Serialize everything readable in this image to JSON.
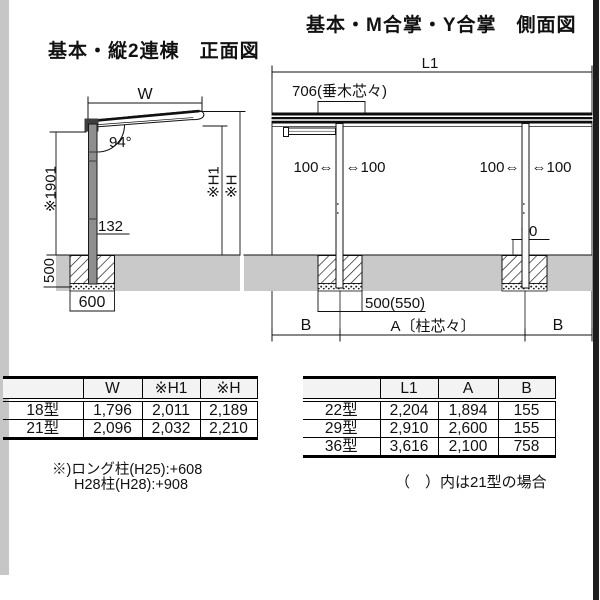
{
  "page": {
    "front_title": "基本・縦2連棟　正面図",
    "side_title": "基本・M合掌・Y合掌　側面図"
  },
  "colors": {
    "ground": "#c9c9c9",
    "ink": "#111111",
    "edge_bar": "#1e1e1e"
  },
  "front_view": {
    "dim_w": "W",
    "dim_angle": "94°",
    "dim_post_height": "※1901",
    "dim_h1": "※H1",
    "dim_h": "※H",
    "dim_base": "132",
    "dim_footing_depth": "500",
    "dim_footing_width": "600"
  },
  "side_view": {
    "dim_l1": "L1",
    "dim_rafter": "706(垂木芯々)",
    "dim_overhang_left_out": "100⇔",
    "dim_overhang_left_in": "⇔100",
    "dim_overhang_right_out": "100⇔",
    "dim_overhang_right_in": "⇔100",
    "dim_edge": "90",
    "dim_footing": "500(550)",
    "dim_b_left": "B",
    "dim_a": "A〔柱芯々〕",
    "dim_b_right": "B"
  },
  "front_table": {
    "headers": [
      "",
      "W",
      "※H1",
      "※H"
    ],
    "rows": [
      {
        "label": "18型",
        "values": [
          "1,796",
          "2,011",
          "2,189"
        ]
      },
      {
        "label": "21型",
        "values": [
          "2,096",
          "2,032",
          "2,210"
        ]
      }
    ],
    "note_line1": "※)ロング柱(H25):+608",
    "note_line2": "H28柱(H28):+908"
  },
  "side_table": {
    "headers": [
      "",
      "L1",
      "A",
      "B"
    ],
    "rows": [
      {
        "label": "22型",
        "values": [
          "2,204",
          "1,894",
          "155"
        ]
      },
      {
        "label": "29型",
        "values": [
          "2,910",
          "2,600",
          "155"
        ]
      },
      {
        "label": "36型",
        "values": [
          "3,616",
          "2,100",
          "758"
        ]
      }
    ],
    "note": "（　）内は21型の場合"
  }
}
